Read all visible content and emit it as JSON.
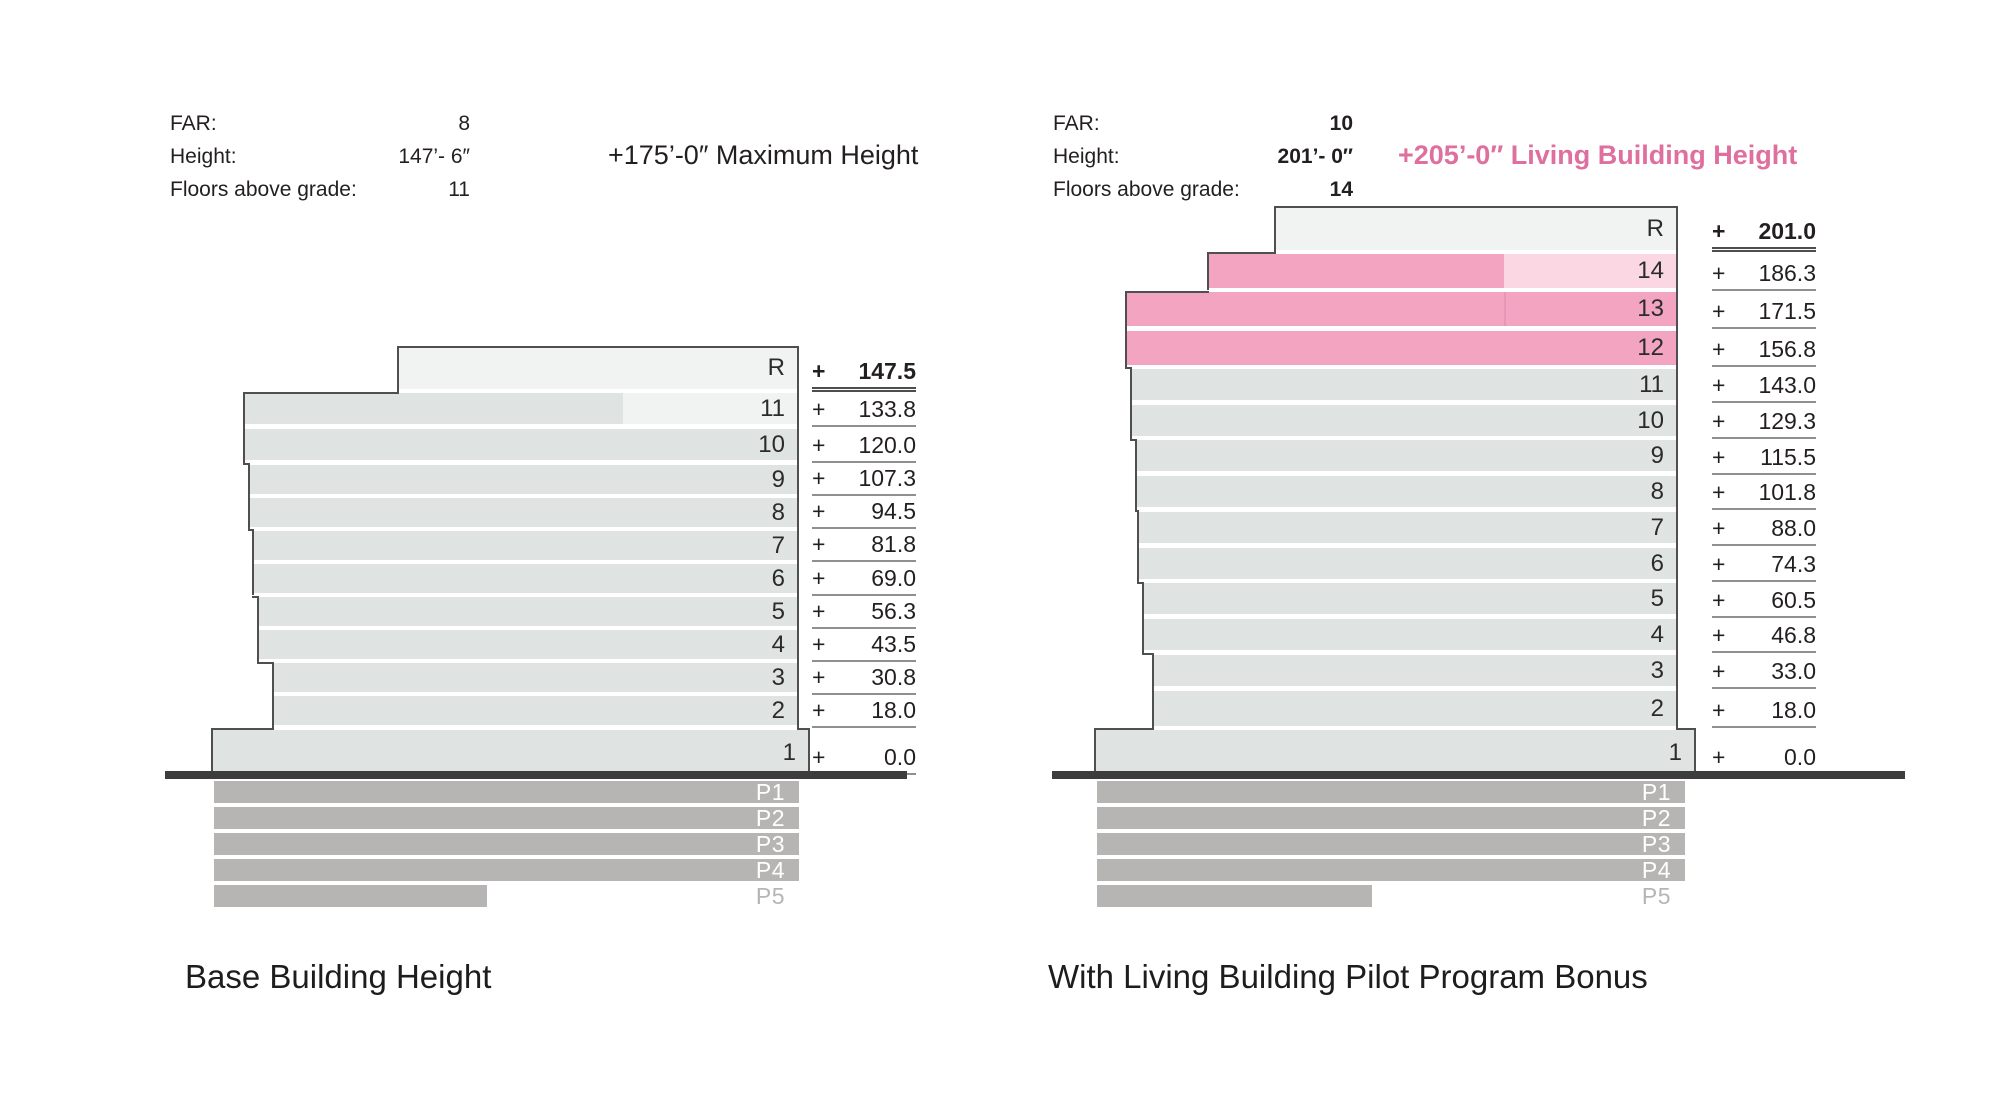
{
  "left_panel": {
    "stats": [
      {
        "label": "FAR:",
        "value": "8"
      },
      {
        "label": "Height:",
        "value": "147’- 6″"
      },
      {
        "label": "Floors above grade:",
        "value": "11"
      }
    ],
    "annotation": "+175’-0″ Maximum Height",
    "caption": "Base Building Height"
  },
  "right_panel": {
    "stats": [
      {
        "label": "FAR:",
        "value": "10"
      },
      {
        "label": "Height:",
        "value": "201’- 0″"
      },
      {
        "label": "Floors above grade:",
        "value": "14"
      }
    ],
    "annotation": "+205’-0″ Living Building Height",
    "caption": "With Living Building Pilot Program Bonus"
  },
  "colors": {
    "floor_gray": "#dfe3e2",
    "floor_gray_light": "#f1f3f2",
    "bonus_pink": "#f2a4c0",
    "bonus_pink_light": "#fad7e3",
    "bonus_pink_divider": "#e697b6",
    "parking_gray": "#b7b4b4",
    "ground": "#3d3d3d",
    "outline": "#4f4f4f",
    "underline": "#909090",
    "accent_pink_text": "#de6f9e"
  },
  "chart_data": [
    {
      "type": "bar",
      "title": "Base Building Height",
      "far": 8,
      "height": "147’- 6″",
      "floors_above_grade": 11,
      "note": "+175’-0″ Maximum Height",
      "ylabel": "Elevation (ft)",
      "floors": [
        {
          "label": "R",
          "elevation": 147.5,
          "display": "147.5",
          "highlight": false
        },
        {
          "label": "11",
          "elevation": 133.8,
          "display": "133.8",
          "highlight": false,
          "two_tone": true
        },
        {
          "label": "10",
          "elevation": 120.0,
          "display": "120.0",
          "highlight": false
        },
        {
          "label": "9",
          "elevation": 107.3,
          "display": "107.3",
          "highlight": false
        },
        {
          "label": "8",
          "elevation": 94.5,
          "display": "94.5",
          "highlight": false
        },
        {
          "label": "7",
          "elevation": 81.8,
          "display": "81.8",
          "highlight": false
        },
        {
          "label": "6",
          "elevation": 69.0,
          "display": "69.0",
          "highlight": false
        },
        {
          "label": "5",
          "elevation": 56.3,
          "display": "56.3",
          "highlight": false
        },
        {
          "label": "4",
          "elevation": 43.5,
          "display": "43.5",
          "highlight": false
        },
        {
          "label": "3",
          "elevation": 30.8,
          "display": "30.8",
          "highlight": false
        },
        {
          "label": "2",
          "elevation": 18.0,
          "display": "18.0",
          "highlight": false
        },
        {
          "label": "1",
          "elevation": 0.0,
          "display": "0.0",
          "highlight": false
        }
      ],
      "below_grade": [
        "P1",
        "P2",
        "P3",
        "P4",
        "P5"
      ]
    },
    {
      "type": "bar",
      "title": "With Living Building Pilot Program Bonus",
      "far": 10,
      "height": "201’- 0″",
      "floors_above_grade": 14,
      "note": "+205’-0″ Living Building Height",
      "ylabel": "Elevation (ft)",
      "floors": [
        {
          "label": "R",
          "elevation": 201.0,
          "display": "201.0",
          "highlight": false
        },
        {
          "label": "14",
          "elevation": 186.3,
          "display": "186.3",
          "highlight": true,
          "two_tone": true
        },
        {
          "label": "13",
          "elevation": 171.5,
          "display": "171.5",
          "highlight": true,
          "divider": true
        },
        {
          "label": "12",
          "elevation": 156.8,
          "display": "156.8",
          "highlight": true
        },
        {
          "label": "11",
          "elevation": 143.0,
          "display": "143.0",
          "highlight": false
        },
        {
          "label": "10",
          "elevation": 129.3,
          "display": "129.3",
          "highlight": false
        },
        {
          "label": "9",
          "elevation": 115.5,
          "display": "115.5",
          "highlight": false
        },
        {
          "label": "8",
          "elevation": 101.8,
          "display": "101.8",
          "highlight": false
        },
        {
          "label": "7",
          "elevation": 88.0,
          "display": "88.0",
          "highlight": false
        },
        {
          "label": "6",
          "elevation": 74.3,
          "display": "74.3",
          "highlight": false
        },
        {
          "label": "5",
          "elevation": 60.5,
          "display": "60.5",
          "highlight": false
        },
        {
          "label": "4",
          "elevation": 46.8,
          "display": "46.8",
          "highlight": false
        },
        {
          "label": "3",
          "elevation": 33.0,
          "display": "33.0",
          "highlight": false
        },
        {
          "label": "2",
          "elevation": 18.0,
          "display": "18.0",
          "highlight": false
        },
        {
          "label": "1",
          "elevation": 0.0,
          "display": "0.0",
          "highlight": false
        }
      ],
      "below_grade": [
        "P1",
        "P2",
        "P3",
        "P4",
        "P5"
      ]
    }
  ]
}
